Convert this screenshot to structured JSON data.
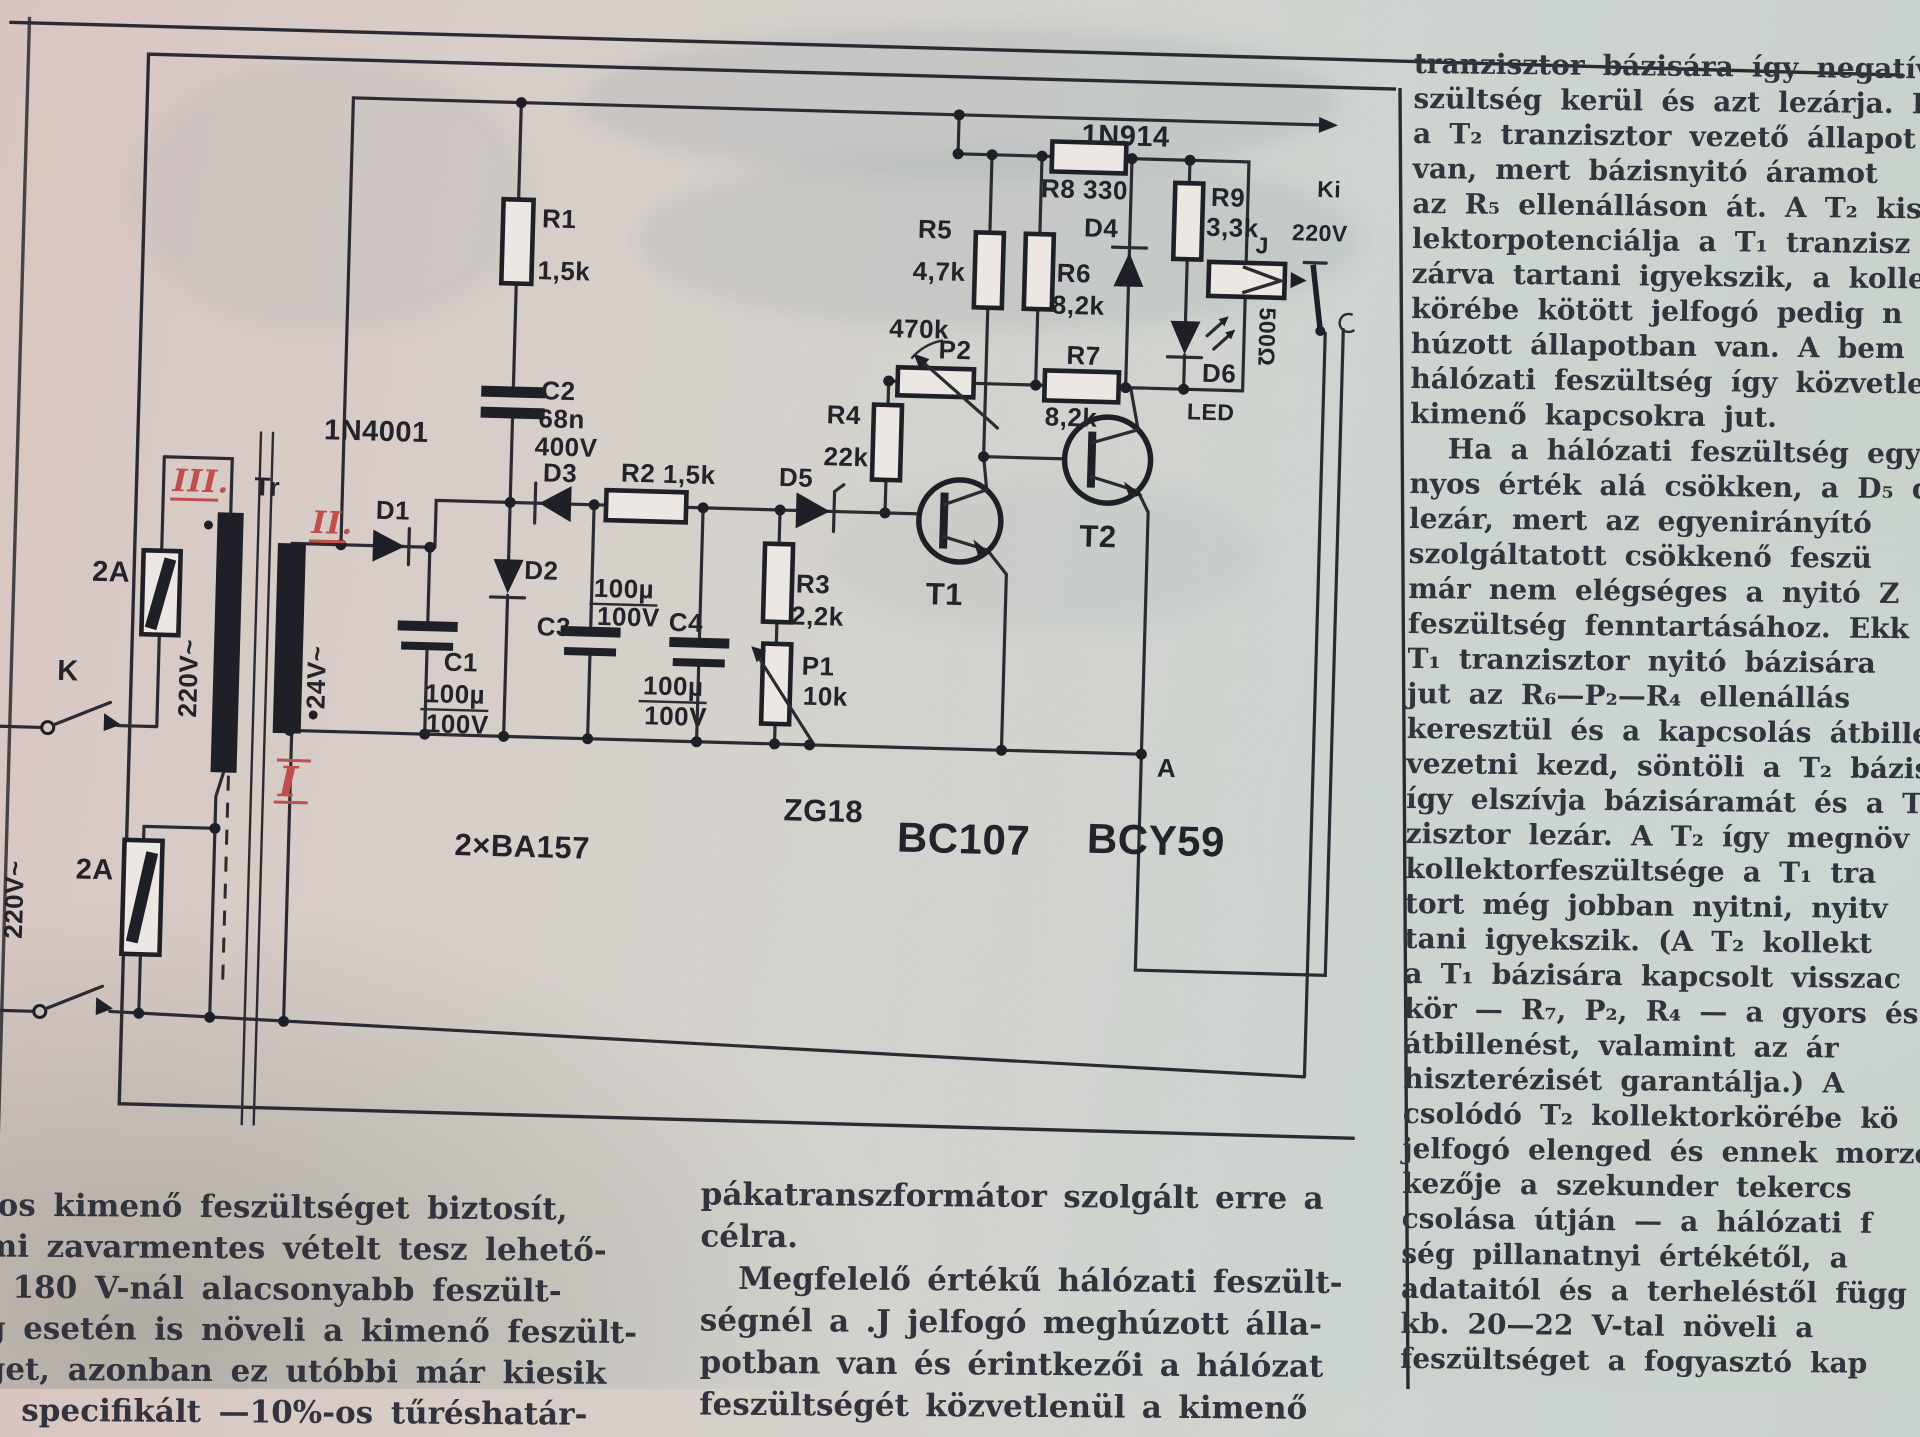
{
  "right_column": {
    "lines": [
      "tranzisztor bázisára így negatív",
      "szültség kerül és azt lezárja. Közb",
      "a T₂ tranzisztor vezető állapot",
      "van, mert bázisnyitó áramot",
      "az R₅ ellenálláson át. A T₂ kis",
      "lektorpotenciálja a T₁ tranzisz",
      "zárva tartani igyekszik, a kollek",
      "körébe kötött jelfogó pedig n",
      "húzott állapotban van. A bem",
      "hálózati feszültség így közvetlen",
      "kimenő kapcsokra jut.",
      "Ha a hálózati feszültség egy",
      "nyos érték alá csökken, a D₅ d",
      "lezár, mert az egyenirányító",
      "szolgáltatott csökkenő feszü",
      "már nem elégséges a nyitó Z",
      "feszültség fenntartásához. Ekk",
      "T₁ tranzisztor nyitó bázisára",
      "jut az R₆—P₂—R₄ ellenállás",
      "keresztül és a kapcsolás átbille",
      "vezetni kezd, söntöli a T₂ bázis",
      "így elszívja bázisáramát és a T₂",
      "zisztor lezár. A T₂ így megnöv",
      "kollektorfeszültsége a T₁ tra",
      "tort még jobban nyitni, nyitv",
      "tani igyekszik. (A T₂ kollekt",
      "a T₁ bázisára kapcsolt visszac",
      "kör — R₇, P₂, R₄ — a gyors és",
      "átbillenést, valamint az ár",
      "hiszterézisét garantálja.) A",
      "csolódó T₂ kollektorkörébe kö",
      "jelfogó elenged és ennek morze",
      "kezője a szekunder tekercs",
      "csolása útján — a hálózati f",
      "ség pillanatnyi értékétől, a",
      "adataitól és a terheléstől függ",
      "kb. 20—22 V-tal növeli a",
      "feszültséget a fogyasztó kap"
    ]
  },
  "bottom_left_column": {
    "lines": [
      "-os kimenő feszültséget biztosít,",
      "mi zavarmentes vételt tesz lehető-",
      ". 180 V-nál alacsonyabb feszült-",
      "g esetén is növeli a kimenő feszült-",
      "get, azonban ez utóbbi már kiesik",
      "specifikált —10%-os tűréshatár-"
    ]
  },
  "bottom_middle_column": {
    "lines": [
      "pákatranszformátor szolgált erre a",
      "célra.",
      "Megfelelő értékű hálózati feszült-",
      "ségnél a .J jelfogó meghúzott álla-",
      "potban van és érintkezői a hálózat",
      "feszültségét közvetlenül a kimenő"
    ]
  },
  "schematic": {
    "colors": {
      "ink": "#2b2b33",
      "red_ink": "#bf4f4d",
      "paper": "#d5cfc9"
    },
    "labels": {
      "n914": "1N914",
      "r8": "R8 330",
      "r9": "R9",
      "r9v": "3,3k",
      "ki1": "Ki",
      "ki2": "220V",
      "d4": "D4",
      "r5": "R5",
      "r5v": "4,7k",
      "r6": "R6",
      "r6v": "8,2k",
      "j": "J",
      "coil": "500Ω",
      "p2k": "470k",
      "p2": "P2",
      "r7": "R7",
      "r7v": "8,2k",
      "d6": "D6",
      "led": "LED",
      "r4": "R4",
      "r4v": "22k",
      "d5": "D5",
      "r1": "R1",
      "r1v": "1,5k",
      "c2": "C2",
      "c2v": "68n",
      "c2u": "400V",
      "n4001": "1N4001",
      "tr": "Tr",
      "d1": "D1",
      "d2": "D2",
      "d3": "D3",
      "r2": "R2 1,5k",
      "r3": "R3",
      "r3v": "2,2k",
      "p1": "P1",
      "p1v": "10k",
      "c1": "C1",
      "c3": "C3",
      "c4": "C4",
      "u1": "100µ",
      "u2": "100V",
      "v220": "220V~",
      "v24": "24V~",
      "k": "K",
      "amp2": "2A",
      "rm1": "I",
      "rm2": "II.",
      "rm3": "III.",
      "ba": "2×BA157",
      "zg": "ZG18",
      "bc107": "BC107",
      "bcy59": "BCY59",
      "a": "A",
      "t1": "T1",
      "t2": "T2"
    }
  }
}
